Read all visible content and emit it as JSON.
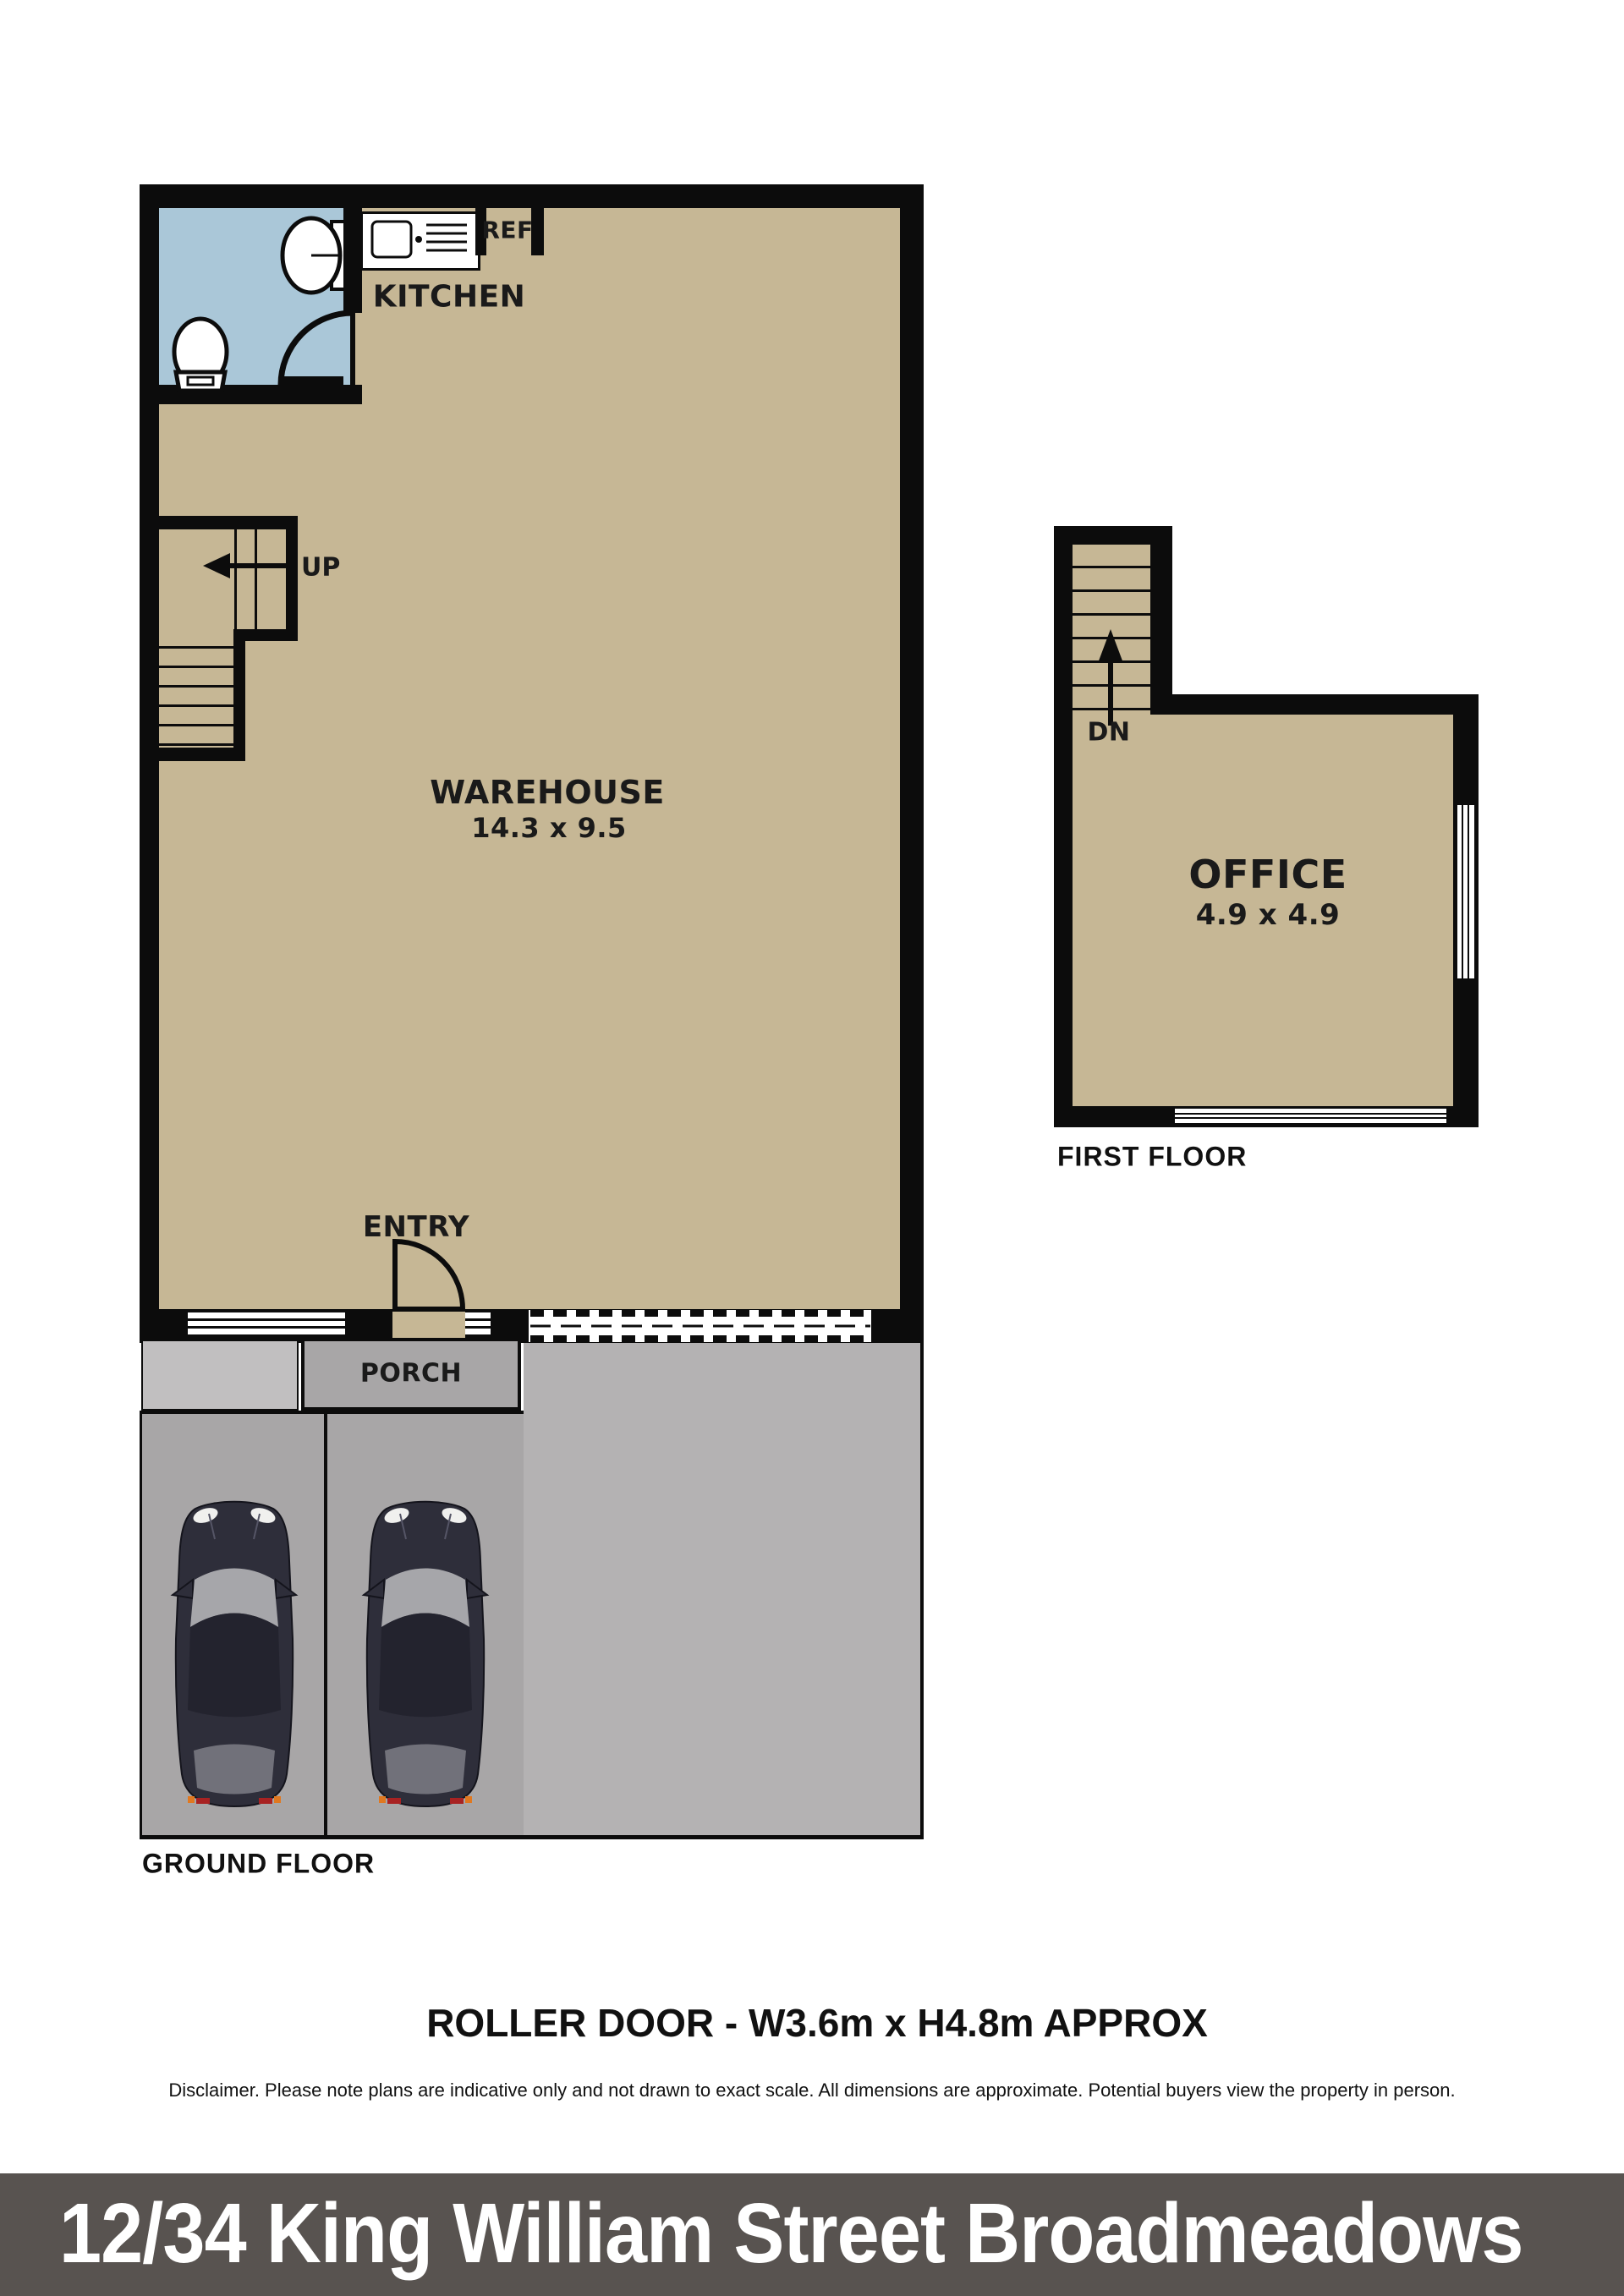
{
  "colors": {
    "wall": "#0c0c0c",
    "floor_tan": "#c6b795",
    "bath_blue": "#aac7d8",
    "porch_gray": "#a8a6a7",
    "drive_gray": "#b4b2b3",
    "light_gray": "#c1bfc0",
    "footer_bg": "#585350",
    "footer_text": "#ffffff",
    "label_ink": "#1a1a1a",
    "car_body": "#2e2e3a",
    "car_glass": "#a6a6aa",
    "car_roof": "#23232e",
    "car_rear_glass": "#71717a"
  },
  "ground_floor": {
    "floor_label": "GROUND FLOOR",
    "kitchen_label": "KITCHEN",
    "ref_label": "REF",
    "up_label": "UP",
    "warehouse_label": "WAREHOUSE",
    "warehouse_dims": "14.3 x 9.5",
    "entry_label": "ENTRY",
    "porch_label": "PORCH"
  },
  "first_floor": {
    "floor_label": "FIRST FLOOR",
    "dn_label": "DN",
    "office_label": "OFFICE",
    "office_dims": "4.9 x 4.9"
  },
  "captions": {
    "roller_door": "ROLLER DOOR - W3.6m x H4.8m APPROX",
    "disclaimer": "Disclaimer. Please note plans are indicative only and not drawn to exact scale. All dimensions are approximate. Potential buyers view the property in person."
  },
  "footer": {
    "address": "12/34 King William Street Broadmeadows"
  }
}
